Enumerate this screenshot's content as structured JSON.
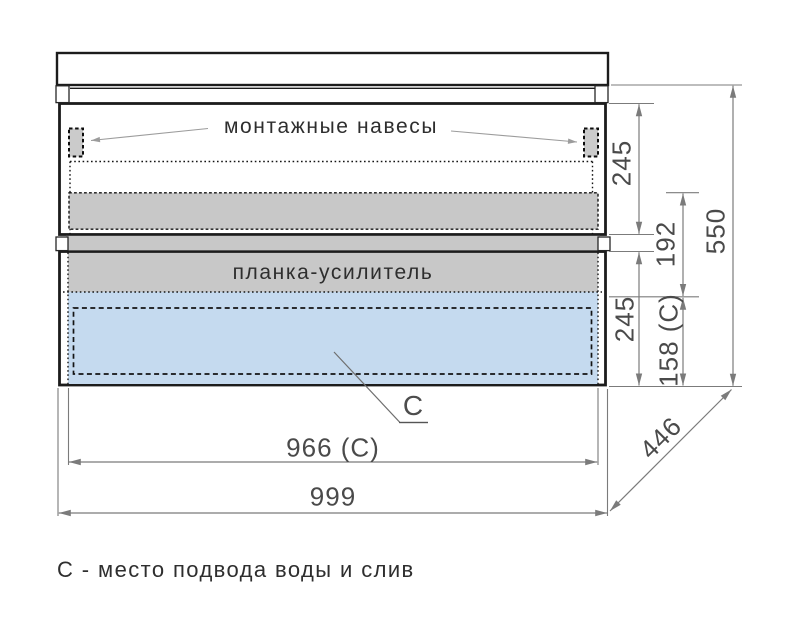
{
  "labels": {
    "mounting_hangers": "монтажные навесы",
    "reinforcement_bar": "планка-усилитель",
    "connection_marker": "C",
    "legend": "С - место подвода воды и слив"
  },
  "dimensions": {
    "upper_box_height": "245",
    "rail_spacing": "192",
    "lower_box_height": "245",
    "connection_height": "158 (C)",
    "overall_height": "550",
    "depth": "446",
    "connection_width": "966 (C)",
    "overall_width": "999"
  },
  "colors": {
    "outline": "#1c1c1c",
    "panel_gray": "#c8c8c8",
    "connection_blue": "#c5daef",
    "dimension_gray": "#7b7b7b",
    "text_gray": "#4a4a4a"
  }
}
